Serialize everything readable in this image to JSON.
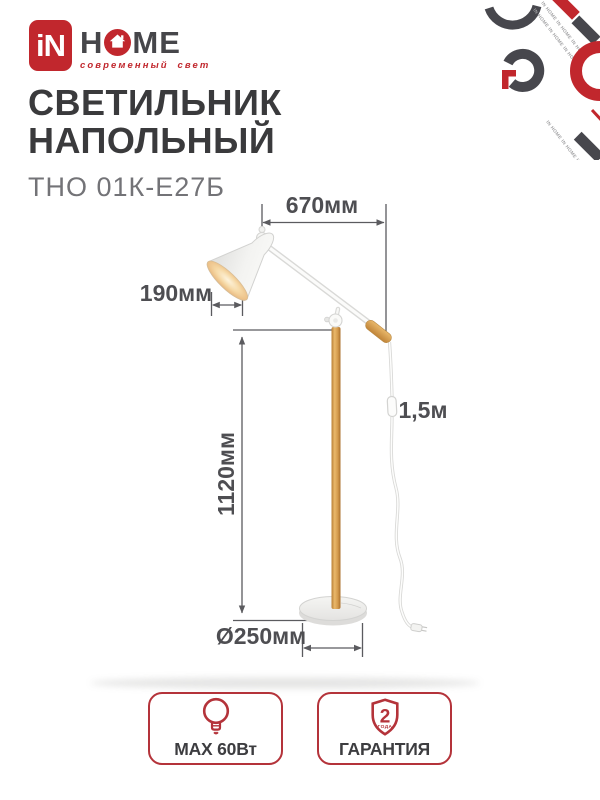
{
  "brand": {
    "logo_mark": "iN",
    "home_left": "H",
    "home_right": "ME",
    "tagline": "современный свет",
    "watermark_text": "IN HOME IN HOME IN HOME"
  },
  "header": {
    "title_line1": "СВЕТИЛЬНИК",
    "title_line2": "НАПОЛЬНЫЙ",
    "model": "ТНО 01К-Е27Б"
  },
  "diagram": {
    "dims": {
      "arm_length": "670мм",
      "shade_diameter": "190мм",
      "pole_height": "1120мм",
      "base_diameter": "Ø250мм",
      "cord_length": "1,5м"
    }
  },
  "badges": {
    "power": {
      "label": "MAX 60Вт",
      "icon": "bulb-icon"
    },
    "warranty": {
      "label": "ГАРАНТИЯ",
      "icon": "shield-icon",
      "shield_number": "2",
      "shield_caption": "ГОДА"
    }
  },
  "colors": {
    "brand_red": "#c1272d",
    "badge_red": "#b4333a",
    "text_dark": "#3a3a3c",
    "dim_gray": "#4e4e52",
    "wood": "#d49a4c"
  }
}
